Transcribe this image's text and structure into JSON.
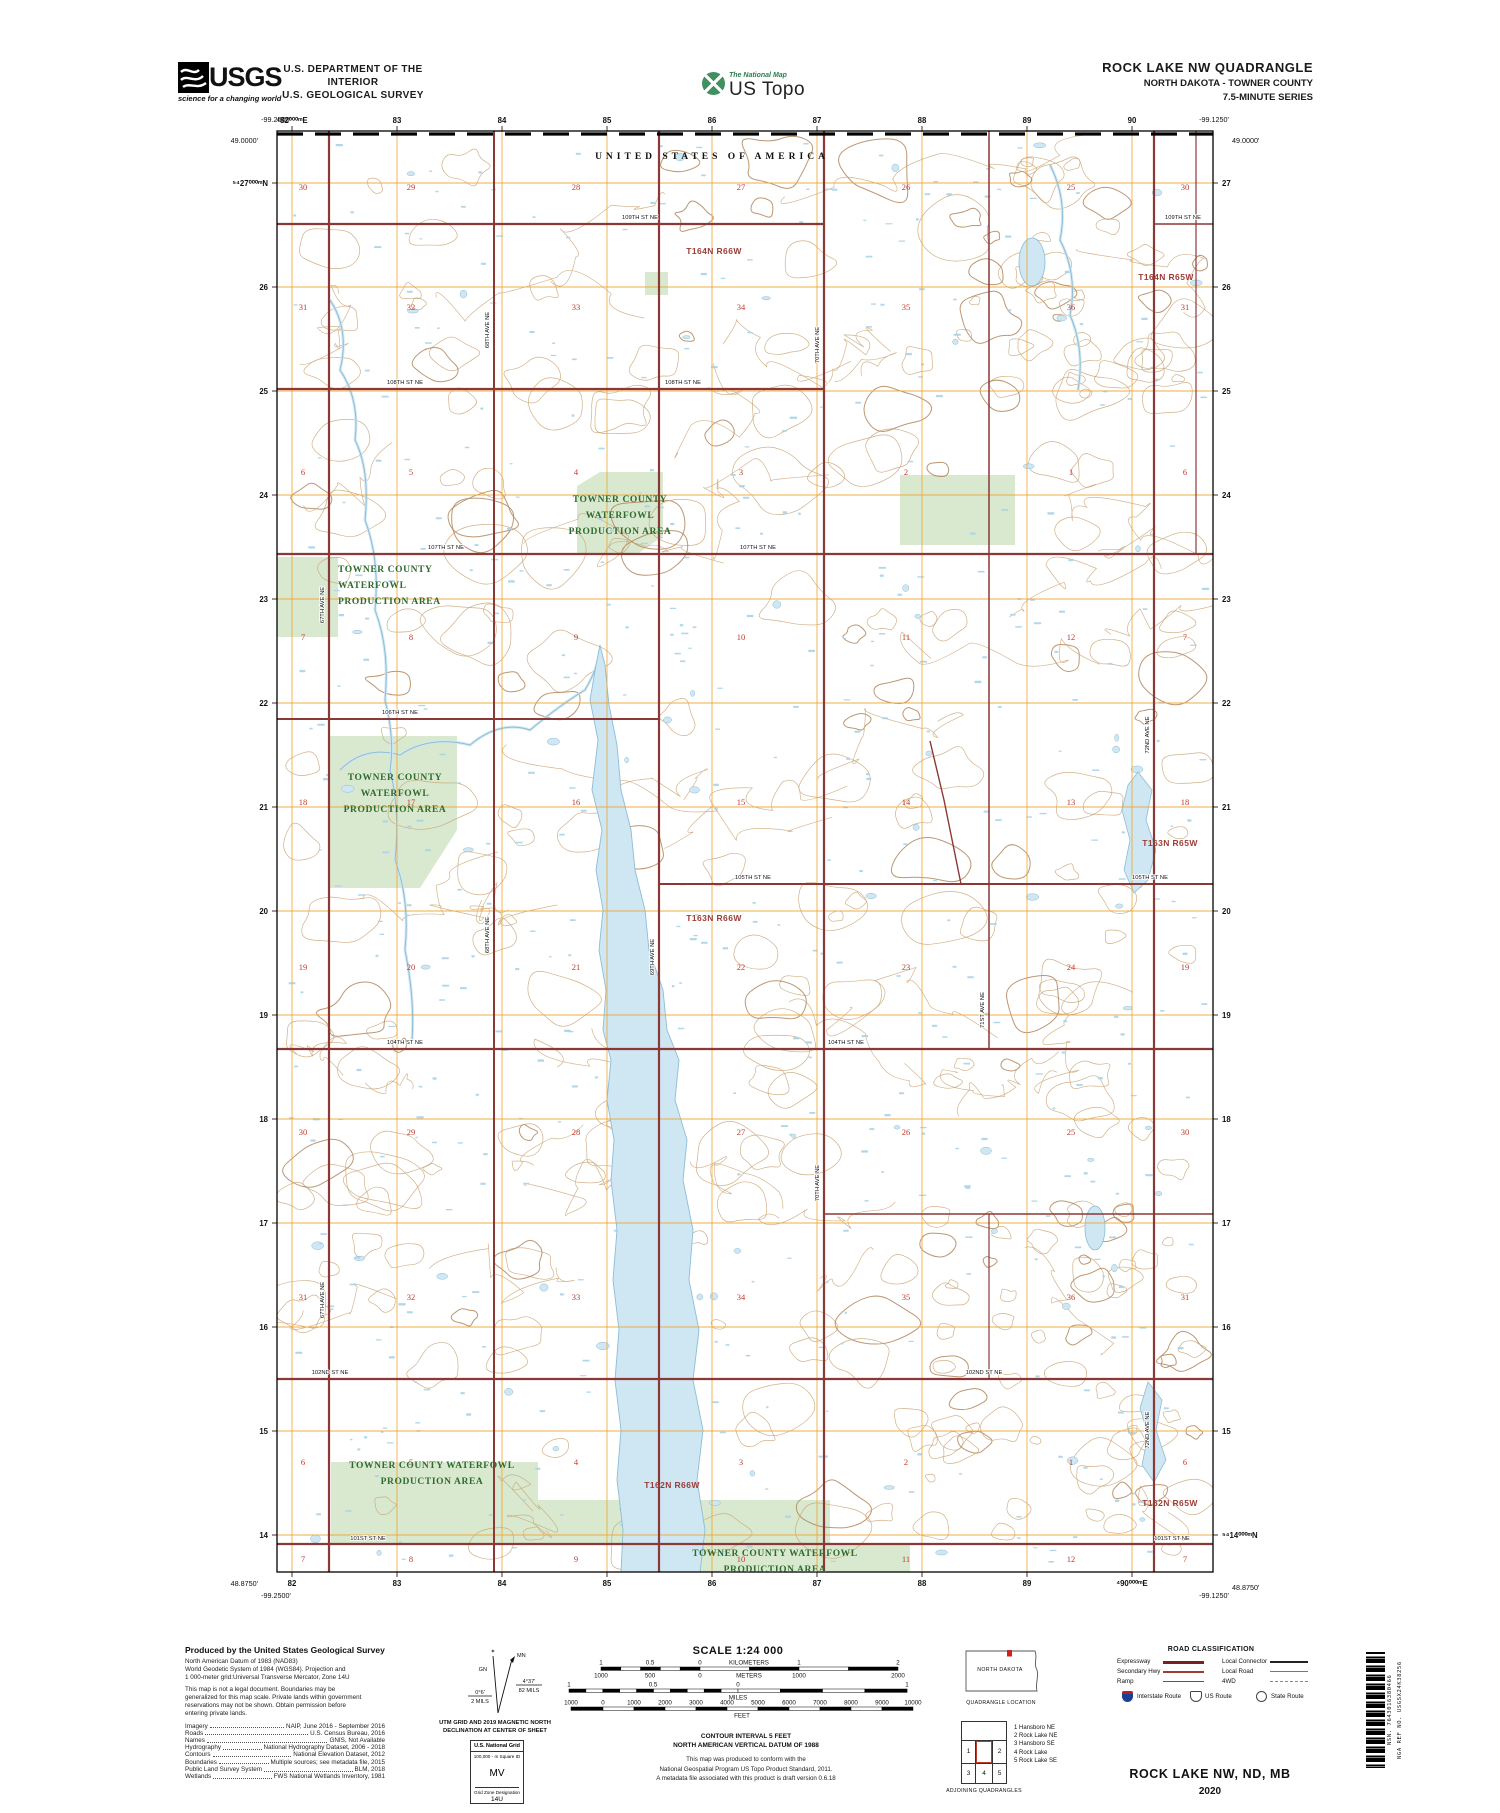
{
  "colors": {
    "contour": "#c9a373",
    "contour_index": "#b2855a",
    "water_fill": "#cfe7f3",
    "water_line": "#8cbdd6",
    "marsh": "#a9d3e8",
    "wpa_fill": "#d9e9cf",
    "wpa_text": "#2e6b2e",
    "road": "#8a3937",
    "grid": "#f0a83c",
    "section": "#c0392b",
    "township": "#9c3c36"
  },
  "header": {
    "usgs_wordmark": "USGS",
    "usgs_tagline": "science for a changing world",
    "dept_line1": "U.S. DEPARTMENT OF THE INTERIOR",
    "dept_line2": "U.S. GEOLOGICAL SURVEY",
    "ustopo_top": "The National Map",
    "ustopo_main": "US Topo",
    "quad_title": "ROCK LAKE NW QUADRANGLE",
    "quad_subtitle": "NORTH DAKOTA - TOWNER COUNTY",
    "quad_series": "7.5-MINUTE SERIES"
  },
  "map": {
    "frame": {
      "left": 277,
      "top": 131,
      "right": 1213,
      "bottom": 1572
    },
    "boundary_label": "UNITED STATES OF AMERICA",
    "corners": [
      {
        "t": "-99.2500'",
        "x": 276,
        "y": 122,
        "anchor": "middle"
      },
      {
        "t": "49.0000'",
        "x": 258,
        "y": 143,
        "anchor": "end"
      },
      {
        "t": "-99.1250'",
        "x": 1214,
        "y": 122,
        "anchor": "middle"
      },
      {
        "t": "49.0000'",
        "x": 1232,
        "y": 143,
        "anchor": "start"
      },
      {
        "t": "48.8750'",
        "x": 258,
        "y": 1586,
        "anchor": "end"
      },
      {
        "t": "-99.2500'",
        "x": 276,
        "y": 1598,
        "anchor": "middle"
      },
      {
        "t": "-99.1250'",
        "x": 1214,
        "y": 1598,
        "anchor": "middle"
      },
      {
        "t": "48.8750'",
        "x": 1232,
        "y": 1590,
        "anchor": "start"
      }
    ],
    "utm": {
      "cols_x": [
        292,
        397,
        502,
        607,
        712,
        817,
        922,
        1027,
        1132
      ],
      "rows_y": [
        183,
        287,
        391,
        495,
        599,
        703,
        807,
        911,
        1015,
        1119,
        1223,
        1327,
        1431,
        1535
      ],
      "top_labels": [
        "⁴82⁰⁰⁰ᵐE",
        "83",
        "84",
        "85",
        "86",
        "87",
        "88",
        "89",
        "90"
      ],
      "bottom_labels": [
        "82",
        "83",
        "84",
        "85",
        "86",
        "87",
        "88",
        "89",
        "⁴90⁰⁰⁰ᵐE"
      ],
      "left_labels": [
        "⁵⁴27⁰⁰⁰ᵐN",
        "26",
        "25",
        "24",
        "23",
        "22",
        "21",
        "20",
        "19",
        "18",
        "17",
        "16",
        "15",
        "14"
      ],
      "right_labels": [
        "27",
        "26",
        "25",
        "24",
        "23",
        "22",
        "21",
        "20",
        "19",
        "18",
        "17",
        "16",
        "15",
        "⁵⁴14⁰⁰⁰ᵐN"
      ]
    },
    "townships": [
      {
        "t": "T164N R66W",
        "x": 714,
        "y": 254
      },
      {
        "t": "T164N R65W",
        "x": 1166,
        "y": 280
      },
      {
        "t": "T163N R66W",
        "x": 714,
        "y": 921
      },
      {
        "t": "T163N R65W",
        "x": 1170,
        "y": 846
      },
      {
        "t": "T162N R66W",
        "x": 672,
        "y": 1488
      },
      {
        "t": "T162N R65W",
        "x": 1170,
        "y": 1506
      }
    ],
    "section_cols": [
      303,
      411,
      576,
      741,
      906,
      1071,
      1185
    ],
    "section_rows": [
      {
        "y": 187,
        "nums": [
          "30",
          "29",
          "28",
          "27",
          "26",
          "25",
          "30"
        ]
      },
      {
        "y": 307,
        "nums": [
          "31",
          "32",
          "33",
          "34",
          "35",
          "36",
          "31"
        ]
      },
      {
        "y": 472,
        "nums": [
          "6",
          "5",
          "4",
          "3",
          "2",
          "1",
          "6"
        ]
      },
      {
        "y": 637,
        "nums": [
          "7",
          "8",
          "9",
          "10",
          "11",
          "12",
          "7"
        ]
      },
      {
        "y": 802,
        "nums": [
          "18",
          "17",
          "16",
          "15",
          "14",
          "13",
          "18"
        ]
      },
      {
        "y": 967,
        "nums": [
          "19",
          "20",
          "21",
          "22",
          "23",
          "24",
          "19"
        ]
      },
      {
        "y": 1132,
        "nums": [
          "30",
          "29",
          "28",
          "27",
          "26",
          "25",
          "30"
        ]
      },
      {
        "y": 1297,
        "nums": [
          "31",
          "32",
          "33",
          "34",
          "35",
          "36",
          "31"
        ]
      },
      {
        "y": 1462,
        "nums": [
          "6",
          "5",
          "4",
          "3",
          "2",
          "1",
          "6"
        ]
      },
      {
        "y": 1559,
        "nums": [
          "7",
          "8",
          "9",
          "10",
          "11",
          "12",
          "7"
        ]
      }
    ],
    "roads": {
      "horizontal": [
        {
          "y": 224,
          "x1": 277,
          "x2": 824,
          "w": 2.2
        },
        {
          "y": 224,
          "x1": 1154,
          "x2": 1213,
          "w": 1.5
        },
        {
          "y": 389,
          "x1": 277,
          "x2": 824,
          "w": 2.2
        },
        {
          "y": 554,
          "x1": 277,
          "x2": 1213,
          "w": 2.2
        },
        {
          "y": 719,
          "x1": 277,
          "x2": 659,
          "w": 2
        },
        {
          "y": 884,
          "x1": 659,
          "x2": 1213,
          "w": 2
        },
        {
          "y": 1049,
          "x1": 277,
          "x2": 1213,
          "w": 2.2
        },
        {
          "y": 1214,
          "x1": 824,
          "x2": 1213,
          "w": 1.5
        },
        {
          "y": 1379,
          "x1": 277,
          "x2": 1213,
          "w": 2.2
        },
        {
          "y": 1544,
          "x1": 277,
          "x2": 1213,
          "w": 2.2
        }
      ],
      "vertical": [
        {
          "x": 329,
          "y1": 131,
          "y2": 1572,
          "w": 2.2
        },
        {
          "x": 494,
          "y1": 131,
          "y2": 1572,
          "w": 2
        },
        {
          "x": 659,
          "y1": 131,
          "y2": 1572,
          "w": 2.2
        },
        {
          "x": 824,
          "y1": 131,
          "y2": 1572,
          "w": 2.2
        },
        {
          "x": 989,
          "y1": 131,
          "y2": 1049,
          "w": 1.5
        },
        {
          "x": 989,
          "y1": 1214,
          "y2": 1379,
          "w": 1.2
        },
        {
          "x": 1154,
          "y1": 131,
          "y2": 1572,
          "w": 2.2
        },
        {
          "x": 1196,
          "y1": 131,
          "y2": 554,
          "w": 1.2
        }
      ],
      "diagonal": [
        {
          "d": "M930,741 L944,800 L961,884",
          "w": 1.4
        }
      ]
    },
    "road_labels": [
      {
        "t": "109TH ST NE",
        "x": 640,
        "y": 219
      },
      {
        "t": "109TH ST NE",
        "x": 1183,
        "y": 219
      },
      {
        "t": "108TH ST NE",
        "x": 405,
        "y": 384
      },
      {
        "t": "108TH ST NE",
        "x": 683,
        "y": 384
      },
      {
        "t": "107TH ST NE",
        "x": 446,
        "y": 549
      },
      {
        "t": "107TH ST NE",
        "x": 758,
        "y": 549
      },
      {
        "t": "106TH ST NE",
        "x": 400,
        "y": 714
      },
      {
        "t": "105TH ST NE",
        "x": 753,
        "y": 879
      },
      {
        "t": "105TH ST NE",
        "x": 1150,
        "y": 879
      },
      {
        "t": "104TH ST NE",
        "x": 405,
        "y": 1044
      },
      {
        "t": "104TH ST NE",
        "x": 846,
        "y": 1044
      },
      {
        "t": "102ND ST NE",
        "x": 330,
        "y": 1374
      },
      {
        "t": "102ND ST NE",
        "x": 984,
        "y": 1374
      },
      {
        "t": "101ST ST NE",
        "x": 368,
        "y": 1540
      },
      {
        "t": "101ST ST NE",
        "x": 1172,
        "y": 1540
      },
      {
        "t": "67TH AVE NE",
        "x": 324,
        "y": 605,
        "v": 1
      },
      {
        "t": "67TH AVE NE",
        "x": 324,
        "y": 1300,
        "v": 1
      },
      {
        "t": "68TH AVE NE",
        "x": 489,
        "y": 330,
        "v": 1
      },
      {
        "t": "68TH AVE NE",
        "x": 489,
        "y": 935,
        "v": 1
      },
      {
        "t": "69TH AVE NE",
        "x": 654,
        "y": 957,
        "v": 1
      },
      {
        "t": "70TH AVE NE",
        "x": 819,
        "y": 345,
        "v": 1
      },
      {
        "t": "70TH AVE NE",
        "x": 819,
        "y": 1183,
        "v": 1
      },
      {
        "t": "71ST AVE NE",
        "x": 984,
        "y": 1010,
        "v": 1
      },
      {
        "t": "72ND AVE NE",
        "x": 1149,
        "y": 735,
        "v": 1
      },
      {
        "t": "72ND AVE NE",
        "x": 1149,
        "y": 1430,
        "v": 1
      }
    ],
    "wpa": {
      "patches": [
        {
          "points": "577,486 600,472 663,472 663,536 636,555 577,555"
        },
        {
          "points": "277,557 338,557 338,637 277,637"
        },
        {
          "points": "330,736 457,736 457,830 420,888 330,888"
        },
        {
          "points": "331,1462 538,1462 538,1544 331,1544"
        },
        {
          "points": "538,1500 830,1500 830,1544 538,1544"
        },
        {
          "points": "640,1544 910,1544 910,1572 640,1572"
        },
        {
          "points": "900,475 1015,475 1015,545 900,545"
        },
        {
          "points": "645,272 668,272 668,295 645,295"
        }
      ],
      "labels": [
        {
          "lines": [
            "TOWNER COUNTY",
            "WATERFOWL",
            "PRODUCTION AREA"
          ],
          "x": 620,
          "y": 502,
          "anchor": "middle"
        },
        {
          "lines": [
            "TOWNER COUNTY",
            "WATERFOWL",
            "PRODUCTION AREA"
          ],
          "x": 338,
          "y": 572,
          "anchor": "start"
        },
        {
          "lines": [
            "TOWNER COUNTY",
            "WATERFOWL",
            "PRODUCTION AREA"
          ],
          "x": 395,
          "y": 780,
          "anchor": "middle"
        },
        {
          "lines": [
            "TOWNER COUNTY WATERFOWL",
            "PRODUCTION AREA"
          ],
          "x": 432,
          "y": 1468,
          "anchor": "middle"
        },
        {
          "lines": [
            "TOWNER COUNTY WATERFOWL",
            "PRODUCTION AREA"
          ],
          "x": 775,
          "y": 1556,
          "anchor": "middle"
        }
      ]
    },
    "water": {
      "lake": "600,645 596,665 590,700 598,740 592,790 602,830 596,870 603,910 599,950 606,990 603,1030 611,1060 607,1100 614,1140 611,1180 617,1230 613,1280 619,1330 615,1380 621,1430 617,1480 623,1530 621,1572 700,1572 705,1530 697,1480 703,1430 693,1380 699,1330 689,1280 693,1230 683,1180 687,1140 675,1100 679,1060 667,1030 663,990 649,950 645,910 635,870 631,830 621,790 617,745 609,705 605,665",
      "polys": [
        "1138,772 1152,790 1146,820 1156,850 1148,880 1134,893 1124,870 1130,840 1122,810 1128,785",
        "1148,1382 1162,1400 1156,1430 1166,1460 1154,1482 1142,1465 1148,1435 1140,1408"
      ],
      "ellipses": [
        {
          "cx": 1095,
          "cy": 1228,
          "rx": 10,
          "ry": 22
        },
        {
          "cx": 1032,
          "cy": 262,
          "rx": 13,
          "ry": 24
        }
      ],
      "creeks": [
        "M340,770 Q365,745 400,755 Q430,735 470,745 Q500,720 530,730 Q560,705 585,690 Q598,668 600,650",
        "M330,300 Q350,330 340,370 Q360,400 355,440 Q370,470 365,520 Q380,560 375,610 Q390,650 385,700 Q395,740 390,770 Q400,810 395,860 Q410,900 405,950 Q415,1000 412,1040",
        "M1050,165 Q1068,200 1060,240 Q1078,275 1070,315 Q1085,350 1078,390"
      ]
    },
    "decor": {
      "seed": 42,
      "blobs": 210,
      "squiggles": 42,
      "dense_blobs": 50,
      "specks": 500,
      "ponds": 66
    }
  },
  "footer": {
    "produced_by": "Produced by the United States Geological Survey",
    "datum_lines": [
      "North American Datum of 1983 (NAD83)",
      "World Geodetic System of 1984 (WGS84).  Projection and",
      "1 000-meter grid:Universal Transverse Mercator, Zone 14U"
    ],
    "legal_lines": [
      "This map is not a legal document. Boundaries may be",
      "generalized for this map scale. Private lands within government",
      "reservations may not be shown. Obtain permission before",
      "entering private lands."
    ],
    "sources": [
      [
        "Imagery",
        "NAIP, June 2016 - September 2016"
      ],
      [
        "Roads",
        "U.S. Census Bureau, 2016"
      ],
      [
        "Names",
        "GNIS, Not Available"
      ],
      [
        "Hydrography",
        "National Hydrography Dataset, 2006 - 2018"
      ],
      [
        "Contours",
        "National Elevation Dataset, 2012"
      ],
      [
        "Boundaries",
        "Multiple sources; see metadata file, 2015"
      ],
      [
        "Public Land Survey System",
        "BLM, 2018"
      ],
      [
        "Wetlands",
        "FWS National Wetlands Inventory, 1981"
      ]
    ],
    "declination": {
      "mn": "MN",
      "gn": "GN",
      "mn_angle": "4°37'",
      "mn_mils": "82 MILS",
      "gn_angle": "0°6'",
      "gn_mils": "2 MILS",
      "caption1": "UTM GRID AND 2019 MAGNETIC NORTH",
      "caption2": "DECLINATION AT CENTER OF SHEET"
    },
    "natgrid": {
      "title": "U.S. National Grid",
      "sub": "100,000 - m Square ID",
      "square": "MV",
      "zone_label": "Grid Zone Designation",
      "zone": "14U"
    },
    "scale": {
      "title": "SCALE 1:24 000",
      "bars": [
        {
          "y": 1667,
          "h": 3.4,
          "x1": 601,
          "x2": 898,
          "zero": 700,
          "nl": 5,
          "nr": 4,
          "above": [
            [
              "1",
              601
            ],
            [
              "0.5",
              650
            ],
            [
              "0",
              700
            ],
            [
              "KILOMETERS",
              749
            ],
            [
              "1",
              799
            ],
            [
              "2",
              898
            ]
          ],
          "below": [
            [
              "1000",
              601
            ],
            [
              "500",
              650
            ],
            [
              "0",
              700
            ],
            [
              "METERS",
              749
            ],
            [
              "1000",
              799
            ],
            [
              "2000",
              898
            ]
          ]
        },
        {
          "y": 1689,
          "h": 3.4,
          "x1": 569,
          "x2": 907,
          "zero": 738,
          "nl": 10,
          "nr": 4,
          "above": [
            [
              "1",
              569
            ],
            [
              "0.5",
              653
            ],
            [
              "0",
              738
            ],
            [
              "1",
              907
            ]
          ],
          "below": [
            [
              "MILES",
              738
            ]
          ]
        },
        {
          "y": 1707,
          "h": 3.4,
          "x1": 571,
          "x2": 913,
          "zero": 603,
          "nl": 1,
          "nr": 10,
          "above": [
            [
              "1000",
              571
            ],
            [
              "0",
              603
            ],
            [
              "1000",
              634
            ],
            [
              "2000",
              665
            ],
            [
              "3000",
              696
            ],
            [
              "4000",
              727
            ],
            [
              "5000",
              758
            ],
            [
              "6000",
              789
            ],
            [
              "7000",
              820
            ],
            [
              "8000",
              851
            ],
            [
              "9000",
              882
            ],
            [
              "10000",
              913
            ]
          ],
          "below": [
            [
              "FEET",
              742
            ]
          ]
        }
      ],
      "contour_note": [
        "CONTOUR INTERVAL 5 FEET",
        "NORTH AMERICAN VERTICAL DATUM OF 1988"
      ],
      "standard_note": [
        "This map was produced to conform with the",
        "National Geospatial Program US Topo Product Standard, 2011.",
        "A metadata file associated with this product is draft version 0.6.18"
      ]
    },
    "location": {
      "state": "NORTH DAKOTA",
      "caption": "QUADRANGLE LOCATION"
    },
    "adjoining": {
      "caption": "ADJOINING QUADRANGLES",
      "cells": [
        "1",
        "2",
        "3",
        "4",
        "5"
      ],
      "legend": [
        "1 Hansboro NE",
        "2 Rock Lake NE",
        "3 Hansboro SE",
        "4 Rock Lake",
        "5 Rock Lake SE"
      ]
    },
    "roadclass": {
      "title": "ROAD CLASSIFICATION",
      "rows": [
        {
          "l": "Expressway",
          "ls": "expressway",
          "r": "Local Connector",
          "rs": "connector"
        },
        {
          "l": "Secondary Hwy",
          "ls": "secondary",
          "r": "Local Road",
          "rs": "local"
        },
        {
          "l": "Ramp",
          "ls": "ramp",
          "r": "4WD",
          "rs": "fourwd"
        }
      ],
      "shields": [
        {
          "label": "Interstate Route",
          "type": "interstate"
        },
        {
          "label": "US Route",
          "type": "us"
        },
        {
          "label": "State Route",
          "type": "state"
        }
      ]
    },
    "barcode": {
      "nsn": "NSN. 7643016380466",
      "nga": "NGA REF NO. USGSX24K38256"
    },
    "sheet_title": "ROCK LAKE NW,  ND, MB",
    "year": "2020"
  }
}
